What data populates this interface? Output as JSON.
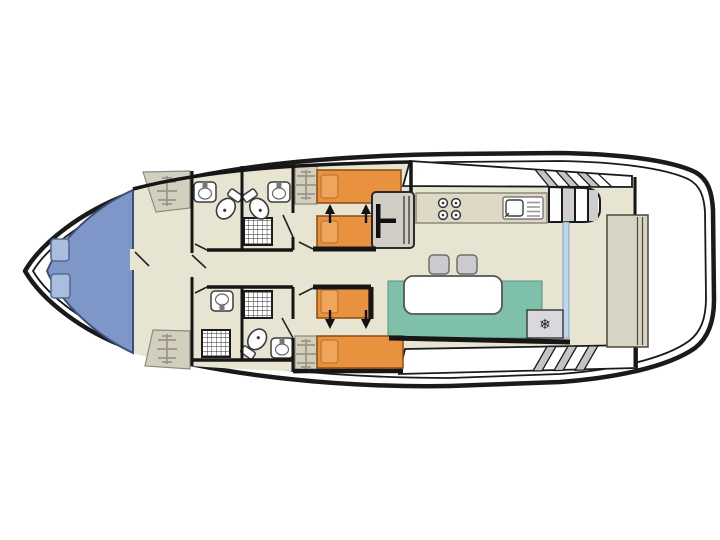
{
  "diagram": {
    "type": "boat-deck-floor-plan",
    "orientation": "bow-left-stern-right",
    "rooms": [
      {
        "name": "foredeck",
        "features": [
          "deck-hatch",
          "deck-hatch"
        ]
      },
      {
        "name": "bow-hallway",
        "features": [
          "wardrobe",
          "wardrobe"
        ]
      },
      {
        "name": "bathroom-port-forward",
        "features": [
          "sink",
          "toilet"
        ]
      },
      {
        "name": "bathroom-port-aft",
        "features": [
          "sink",
          "toilet",
          "shower"
        ]
      },
      {
        "name": "cabin-port",
        "features": [
          "single-bed",
          "single-bed",
          "wardrobe",
          "access-arrows"
        ]
      },
      {
        "name": "bathroom-starboard-forward",
        "features": [
          "sink",
          "shower"
        ]
      },
      {
        "name": "bathroom-starboard-aft",
        "features": [
          "shower",
          "toilet",
          "sink"
        ]
      },
      {
        "name": "cabin-starboard",
        "features": [
          "single-bed",
          "single-bed",
          "wardrobe",
          "access-arrows"
        ]
      },
      {
        "name": "helm-station",
        "features": [
          "steering-wheel"
        ]
      },
      {
        "name": "galley",
        "features": [
          "stove-4-burners",
          "sink-with-drainer",
          "companionway-stairs"
        ]
      },
      {
        "name": "saloon",
        "features": [
          "dinette-bench",
          "table",
          "stool",
          "stool",
          "fridge",
          "glass-door"
        ]
      },
      {
        "name": "side-deck-port",
        "features": [
          "steps"
        ]
      },
      {
        "name": "side-deck-starboard",
        "features": [
          "steps"
        ]
      },
      {
        "name": "aft-deck",
        "features": [
          "transom-bench"
        ]
      }
    ]
  },
  "icons": {
    "snowflake": "❄"
  },
  "colors": {
    "hull_stroke": "#1a1a1a",
    "deck_white": "#ffffff",
    "foredeck": "#7e97c8",
    "foredeck_border": "#3d5078",
    "hatch": "#a9bedf",
    "hatch_border": "#556a94",
    "floor": "#e8e4d2",
    "wall": "#161616",
    "wardrobe": "#d3cfbe",
    "wardrobe_lines": "#9a9586",
    "bed": "#e8913f",
    "bed_border": "#8a4d10",
    "pillow": "#f0a55c",
    "pillow_border": "#c07830",
    "bench": "#7fc0aa",
    "bench_border": "#57947f",
    "table": "#ffffff",
    "counter": "#ded9c4",
    "counter_border": "#8c897c",
    "stool": "#cbcbcf",
    "fridge": "#d9d9dd",
    "helm": "#d2cec6",
    "steps_shade": "#c4c4c4",
    "stairs_shade": "#cfcfcf",
    "glass": "#bcd6ea",
    "glass_border": "#6e95b5",
    "aft_bench": "#d8d4c3",
    "aft_bench_border": "#4a473e",
    "fixture_stroke": "#3c3c3c"
  }
}
